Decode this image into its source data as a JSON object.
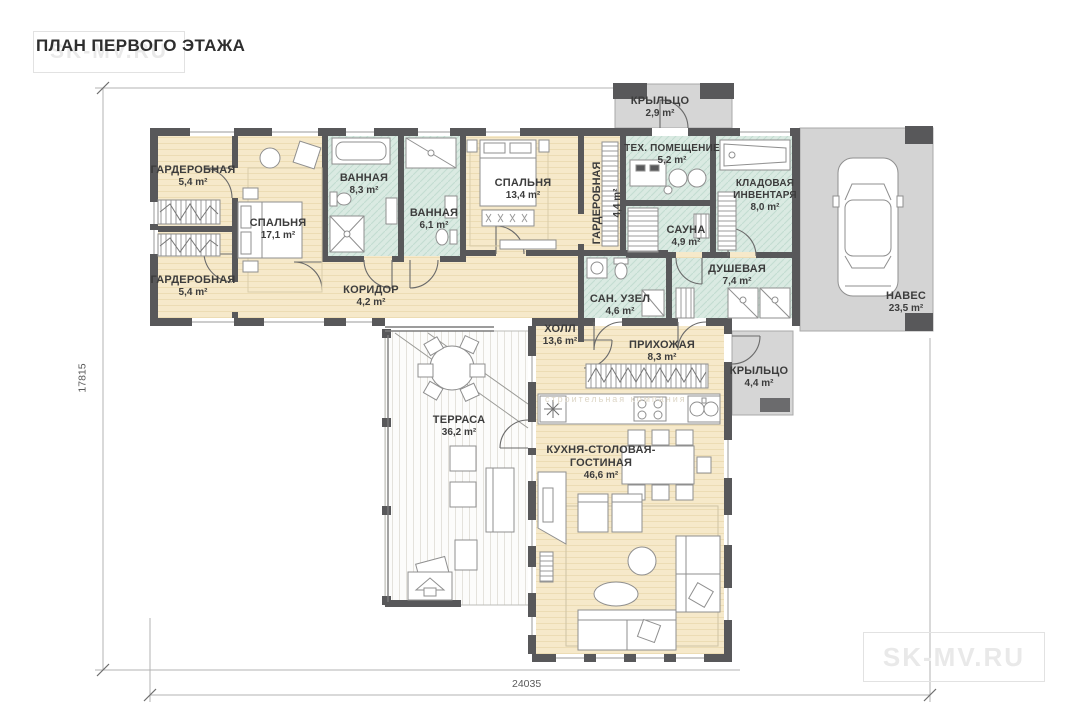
{
  "title": "ПЛАН ПЕРВОГО ЭТАЖА",
  "watermarks": {
    "corner": "SK-MV.RU",
    "small": "строительная компания"
  },
  "dimensions": {
    "vertical": "17815",
    "horizontal": "24035"
  },
  "colors": {
    "wall": "#58585a",
    "floor_beige": "#f6e9ca",
    "tile_green": "#daeae2",
    "porch_gray": "#d6d6d6",
    "terrace_white": "#fcfcfb"
  },
  "rooms": {
    "wardrobe1": {
      "name": "ГАРДЕРОБНАЯ",
      "area": "5,4 m²"
    },
    "wardrobe2": {
      "name": "ГАРДЕРОБНАЯ",
      "area": "5,4 m²"
    },
    "bedroom1": {
      "name": "СПАЛЬНЯ",
      "area": "17,1 m²"
    },
    "bath1": {
      "name": "ВАННАЯ",
      "area": "8,3 m²"
    },
    "bath2": {
      "name": "ВАННАЯ",
      "area": "6,1 m²"
    },
    "bedroom2": {
      "name": "СПАЛЬНЯ",
      "area": "13,4 m²"
    },
    "wardrobe3": {
      "name": "ГАРДЕРОБНАЯ",
      "area": "4,4 m²"
    },
    "tech": {
      "name": "ТЕХ. ПОМЕЩЕНИЕ",
      "area": "5,2 m²"
    },
    "porch_top": {
      "name": "КРЫЛЬЦО",
      "area": "2,9 m²"
    },
    "storage": {
      "name": "КЛАДОВАЯ ИНВЕНТАРЯ",
      "area": "8,0 m²"
    },
    "sauna": {
      "name": "САУНА",
      "area": "4,9 m²"
    },
    "shower": {
      "name": "ДУШЕВАЯ",
      "area": "7,4 m²"
    },
    "wc": {
      "name": "САН. УЗЕЛ",
      "area": "4,6 m²"
    },
    "corridor": {
      "name": "КОРИДОР",
      "area": "4,2 m²"
    },
    "hall": {
      "name": "ХОЛЛ",
      "area": "13,6 m²"
    },
    "entry": {
      "name": "ПРИХОЖАЯ",
      "area": "8,3 m²"
    },
    "porch_right": {
      "name": "КРЫЛЬЦО",
      "area": "4,4 m²"
    },
    "carport": {
      "name": "НАВЕС",
      "area": "23,5 m²"
    },
    "terrace": {
      "name": "ТЕРРАСА",
      "area": "36,2 m²"
    },
    "kitchen": {
      "name": "КУХНЯ-СТОЛОВАЯ-ГОСТИНАЯ",
      "area": "46,6 m²"
    }
  }
}
